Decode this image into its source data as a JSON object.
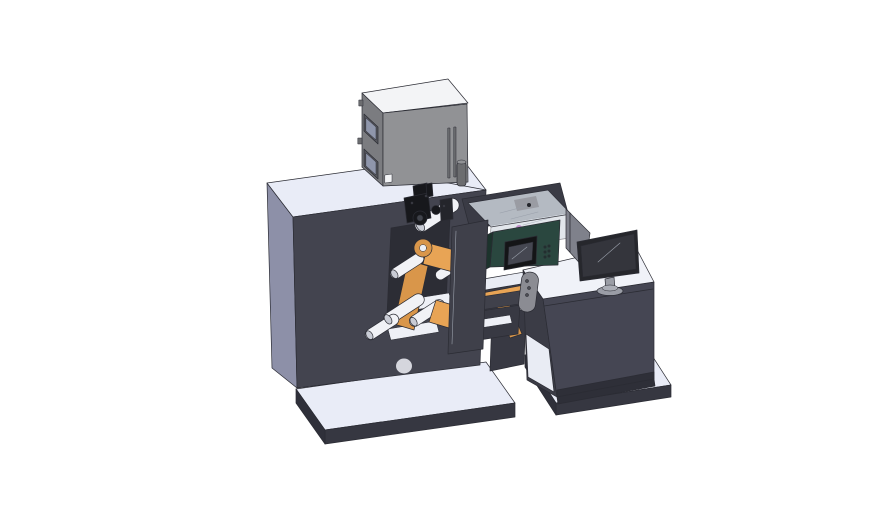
{
  "scene": {
    "background": "#ffffff",
    "type": "3d-cad-isometric-render",
    "subject": "label printing press with unwind rollers, electrical cabinet, inspection glass cover, control screen and operator desk with monitor"
  },
  "colors": {
    "platform_top": "#e9ecf7",
    "platform_side": "#363741",
    "platform_side_dark": "#2f303a",
    "body_front": "#43444f",
    "body_side": "#8d90a8",
    "body_top": "#e9ecf7",
    "cabinet_top": "#f3f4f6",
    "cabinet_front": "#919295",
    "cabinet_side": "#7b7c80",
    "cabinet_detail": "#6c6d70",
    "window_outer": "#55565c",
    "window_inner": "#8f96ab",
    "recess": "#2c2d35",
    "roller_body": "#f1f2f6",
    "roller_end": "#c9ccd5",
    "web_orange": "#e8a455",
    "web_orange_dark": "#d9964a",
    "plate": "#3f404a",
    "mech_dark": "#17181c",
    "mech_mid": "#24252b",
    "mech_inner": "#40434b",
    "teal_front": "#2a473f",
    "teal_dark": "#1c332c",
    "pcb_green": "#2e6b4f",
    "screen_frame": "#141517",
    "screen_inner": "#454751",
    "glass": "#d3dae2",
    "glass_front": "#c7ced9",
    "glass_block": "#9a9ca3",
    "shelf_white": "#e9ecf4",
    "under_dark": "#3a3b45",
    "column": "#383943",
    "bridge": "#40414b",
    "handle": "#8b8c93",
    "handle_dot": "#55565c",
    "desk_front": "#454653",
    "desk_side": "#3b3c46",
    "desk_top": "#f0f2f8",
    "desk_foot": "#2e2f38",
    "monitor_frame": "#26272c",
    "monitor_screen": "#34353c",
    "monitor_stand": "#9a9da6",
    "monitor_base_top": "#aaadb6",
    "divider": "#7f818b",
    "magenta": "#b94fb9",
    "white_detail": "#eef0f6"
  }
}
